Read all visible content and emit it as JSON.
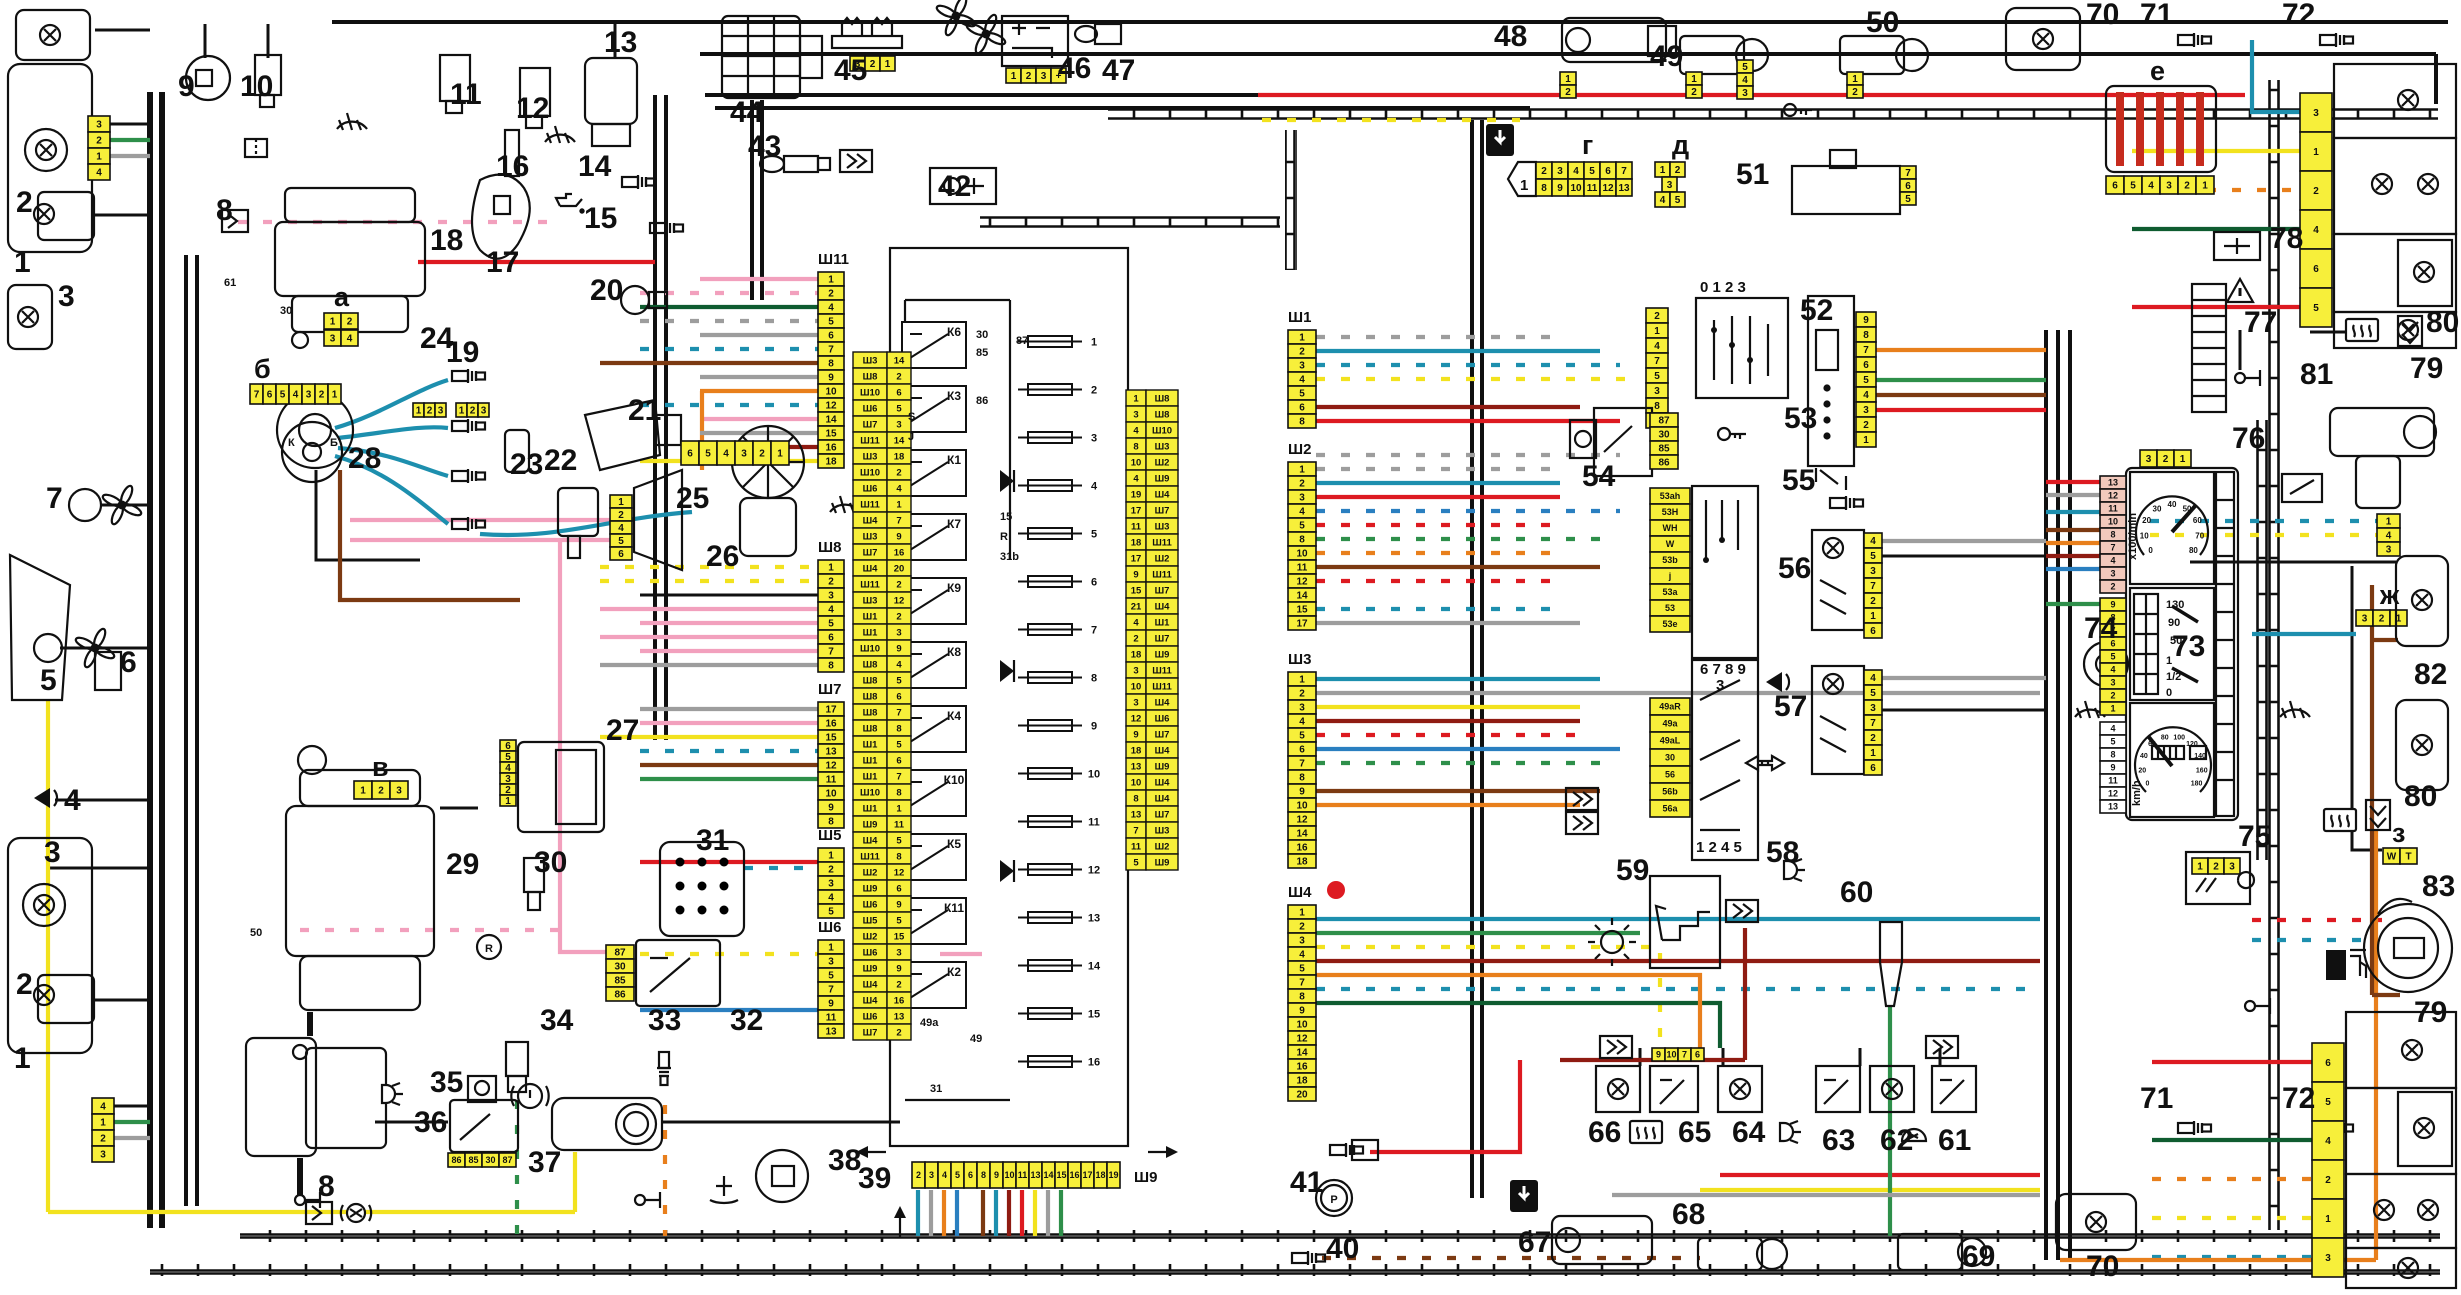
{
  "diagram": {
    "kind": "automotive wiring schematic",
    "note": "full-car electrical diagram with numbered components, connector blocks and central fuse-relay box",
    "bg": "#ffffff"
  },
  "palette": {
    "connector_yellow": "#f7ef3a",
    "block_blue": "#cfeff8",
    "glass_blue": "#bfe7f5",
    "lamp_orange": "#f08020",
    "lamp_red": "#e23b2e",
    "wire_red": "#dd1a21",
    "wire_pink": "#f2a0bd",
    "wire_teal": "#1d8fae",
    "wire_yellow": "#f2e21e",
    "wire_orange": "#e87f1c",
    "wire_green": "#2e8f4a",
    "wire_brown": "#7c3a12",
    "wire_gray": "#9d9d9d"
  },
  "labels": {
    "1": "1",
    "2": "2",
    "3": "3",
    "4": "4",
    "5": "5",
    "6": "6",
    "7": "7",
    "8": "8",
    "9": "9",
    "10": "10",
    "11": "11",
    "12": "12",
    "13": "13",
    "14": "14",
    "15": "15",
    "16": "16",
    "17": "17",
    "18": "18",
    "19": "19",
    "20": "20",
    "21": "21",
    "22": "22",
    "23": "23",
    "24": "24",
    "25": "25",
    "26": "26",
    "27": "27",
    "28": "28",
    "29": "29",
    "30": "30",
    "31": "31",
    "32": "32",
    "33": "33",
    "34": "34",
    "35": "35",
    "36": "36",
    "37": "37",
    "38": "38",
    "39": "39",
    "40": "40",
    "41": "41",
    "42": "42",
    "43": "43",
    "44": "44",
    "45": "45",
    "46": "46",
    "47": "47",
    "48": "48",
    "49": "49",
    "50": "50",
    "51": "51",
    "52": "52",
    "53": "53",
    "54": "54",
    "55": "55",
    "56": "56",
    "57": "57",
    "58": "58",
    "59": "59",
    "60": "60",
    "61": "61",
    "62": "62",
    "63": "63",
    "64": "64",
    "65": "65",
    "66": "66",
    "67": "67",
    "68": "68",
    "69": "69",
    "70": "70",
    "71": "71",
    "72": "72",
    "73": "73",
    "74": "74",
    "75": "75",
    "76": "76",
    "77": "77",
    "78": "78",
    "79": "79",
    "80": "80",
    "81": "81",
    "82": "82",
    "83": "83"
  },
  "letters": {
    "a": "а",
    "b": "б",
    "v": "в",
    "g": "г",
    "d": "д",
    "e": "е",
    "zh": "ж",
    "z": "з"
  },
  "wiremarks": {
    "m50": "50",
    "m61": "61",
    "m30": "30",
    "mK": "К",
    "mB": "Б",
    "mP": "P",
    "mR": "R"
  },
  "block": {
    "number": "39",
    "relays": [
      "К6",
      "К3",
      "К1",
      "К7",
      "К9",
      "К8",
      "К4",
      "К10",
      "К5",
      "К11",
      "К2"
    ],
    "fuses": [
      "1",
      "2",
      "3",
      "4",
      "5",
      "6",
      "7",
      "8",
      "9",
      "10",
      "11",
      "12",
      "13",
      "14",
      "15",
      "16"
    ],
    "marks": {
      "t30": "30",
      "t85": "85",
      "t86": "86",
      "t87": "87",
      "t15": "15",
      "t31": "31",
      "t31b": "31b",
      "tR": "R",
      "tJ": "J",
      "tS": "S",
      "t49a": "49a",
      "t49": "49"
    },
    "left_table": [
      [
        "Ш3",
        "14"
      ],
      [
        "Ш8",
        "2"
      ],
      [
        "Ш10",
        "6"
      ],
      [
        "Ш6",
        "5"
      ],
      [
        "Ш7",
        "3"
      ],
      [
        "Ш11",
        "14"
      ],
      [
        "Ш3",
        "18"
      ],
      [
        "Ш10",
        "2"
      ],
      [
        "Ш6",
        "4"
      ],
      [
        "Ш11",
        "1"
      ],
      [
        "Ш4",
        "7"
      ],
      [
        "Ш3",
        "9"
      ],
      [
        "Ш7",
        "16"
      ],
      [
        "Ш4",
        "20"
      ],
      [
        "Ш11",
        "2"
      ],
      [
        "Ш3",
        "12"
      ],
      [
        "Ш1",
        "2"
      ],
      [
        "Ш1",
        "3"
      ],
      [
        "Ш10",
        "9"
      ],
      [
        "Ш8",
        "4"
      ],
      [
        "Ш8",
        "5"
      ],
      [
        "Ш8",
        "6"
      ],
      [
        "Ш8",
        "7"
      ],
      [
        "Ш8",
        "8"
      ],
      [
        "Ш1",
        "5"
      ],
      [
        "Ш1",
        "6"
      ],
      [
        "Ш1",
        "7"
      ],
      [
        "Ш10",
        "8"
      ],
      [
        "Ш1",
        "1"
      ],
      [
        "Ш9",
        "11"
      ],
      [
        "Ш4",
        "5"
      ],
      [
        "Ш11",
        "8"
      ],
      [
        "Ш2",
        "12"
      ],
      [
        "Ш9",
        "6"
      ],
      [
        "Ш6",
        "9"
      ],
      [
        "Ш5",
        "5"
      ],
      [
        "Ш2",
        "15"
      ],
      [
        "Ш6",
        "3"
      ],
      [
        "Ш9",
        "9"
      ],
      [
        "Ш4",
        "2"
      ],
      [
        "Ш4",
        "16"
      ],
      [
        "Ш6",
        "13"
      ],
      [
        "Ш7",
        "2"
      ]
    ],
    "right_table": [
      [
        "1",
        "Ш8"
      ],
      [
        "3",
        "Ш8"
      ],
      [
        "4",
        "Ш10"
      ],
      [
        "8",
        "Ш3"
      ],
      [
        "10",
        "Ш2"
      ],
      [
        "4",
        "Ш9"
      ],
      [
        "19",
        "Ш4"
      ],
      [
        "17",
        "Ш7"
      ],
      [
        "11",
        "Ш3"
      ],
      [
        "18",
        "Ш11"
      ],
      [
        "17",
        "Ш2"
      ],
      [
        "9",
        "Ш11"
      ],
      [
        "15",
        "Ш7"
      ],
      [
        "21",
        "Ш4"
      ],
      [
        "4",
        "Ш1"
      ],
      [
        "2",
        "Ш7"
      ],
      [
        "18",
        "Ш9"
      ],
      [
        "3",
        "Ш11"
      ],
      [
        "10",
        "Ш11"
      ],
      [
        "3",
        "Ш4"
      ],
      [
        "12",
        "Ш6"
      ],
      [
        "9",
        "Ш7"
      ],
      [
        "18",
        "Ш4"
      ],
      [
        "13",
        "Ш9"
      ],
      [
        "10",
        "Ш4"
      ],
      [
        "8",
        "Ш4"
      ],
      [
        "13",
        "Ш7"
      ],
      [
        "7",
        "Ш3"
      ],
      [
        "11",
        "Ш2"
      ],
      [
        "5",
        "Ш9"
      ]
    ]
  },
  "conn": {
    "sh11": {
      "name": "Ш11",
      "pins": [
        "1",
        "2",
        "4",
        "5",
        "6",
        "7",
        "8",
        "9",
        "10",
        "12",
        "14",
        "15",
        "16",
        "18"
      ]
    },
    "sh8": {
      "name": "Ш8",
      "pins": [
        "1",
        "2",
        "3",
        "4",
        "5",
        "6",
        "7",
        "8"
      ]
    },
    "sh7": {
      "name": "Ш7",
      "pins": [
        "17",
        "16",
        "15",
        "13",
        "12",
        "11",
        "10",
        "9",
        "8"
      ]
    },
    "sh5": {
      "name": "Ш5",
      "pins": [
        "1",
        "2",
        "3",
        "4",
        "5"
      ]
    },
    "sh6": {
      "name": "Ш6",
      "pins": [
        "1",
        "3",
        "5",
        "7",
        "9",
        "11",
        "13"
      ]
    },
    "sh9": {
      "name": "Ш9",
      "pins": [
        "2",
        "3",
        "4",
        "5",
        "6",
        "8",
        "9",
        "10",
        "11",
        "13",
        "14",
        "15",
        "16",
        "17",
        "18",
        "19"
      ]
    },
    "sh1": {
      "name": "Ш1",
      "pins": [
        "1",
        "2",
        "3",
        "4",
        "5",
        "6",
        "8"
      ]
    },
    "sh2": {
      "name": "Ш2",
      "pins": [
        "1",
        "2",
        "3",
        "4",
        "5",
        "8",
        "10",
        "11",
        "12",
        "14",
        "15",
        "17"
      ]
    },
    "sh3": {
      "name": "Ш3",
      "pins": [
        "1",
        "2",
        "3",
        "4",
        "5",
        "6",
        "7",
        "8",
        "9",
        "10",
        "12",
        "14",
        "16",
        "18"
      ]
    },
    "sh4": {
      "name": "Ш4",
      "pins": [
        "1",
        "2",
        "3",
        "4",
        "5",
        "7",
        "8",
        "9",
        "10",
        "12",
        "14",
        "16",
        "18",
        "20"
      ]
    },
    "hl_top": [
      "3",
      "2",
      "1",
      "4"
    ],
    "hl_bot": [
      "4",
      "1",
      "2",
      "3"
    ],
    "a1": [
      "1",
      "2"
    ],
    "a2": [
      "3",
      "4"
    ],
    "b": [
      "7",
      "6",
      "5",
      "4",
      "3",
      "2",
      "1"
    ],
    "v": [
      "1",
      "2",
      "3"
    ],
    "g1": [
      "2",
      "3",
      "4",
      "5",
      "6",
      "7"
    ],
    "g2": [
      "8",
      "9",
      "10",
      "11",
      "12",
      "13"
    ],
    "g0": "1",
    "d1": [
      "1",
      "2"
    ],
    "d2": [
      "3"
    ],
    "d3": [
      "4",
      "5"
    ],
    "e": [
      "6",
      "5",
      "4",
      "3",
      "2",
      "1"
    ],
    "zh": [
      "3",
      "2",
      "1"
    ],
    "z": [
      "W",
      "T"
    ],
    "c45": [
      "3",
      "2",
      "1"
    ],
    "c46": [
      "1",
      "2",
      "3",
      "+"
    ],
    "c48": [
      "1",
      "2"
    ],
    "c49": [
      "1",
      "2"
    ],
    "c50": [
      "1",
      "2"
    ],
    "c50b": [
      "5",
      "4",
      "3"
    ],
    "c51": [
      "7",
      "6",
      "5"
    ],
    "c52": [
      "2",
      "1",
      "4",
      "7",
      "5",
      "3",
      "8",
      "6"
    ],
    "c52_header": "0 1 2 3",
    "c53": [
      "9",
      "8",
      "7",
      "6",
      "5",
      "4",
      "3",
      "2",
      "1"
    ],
    "c54": [
      "87",
      "30",
      "85",
      "86"
    ],
    "c56": [
      "4",
      "5",
      "3",
      "7",
      "2",
      "1",
      "6"
    ],
    "c57": [
      "4",
      "5",
      "3",
      "7",
      "2",
      "1",
      "6"
    ],
    "c58u": [
      "53ah",
      "53H",
      "WH",
      "W",
      "53b",
      "j",
      "53a",
      "53",
      "53e"
    ],
    "c58u_n1": "6 7 8 9",
    "c58u_n2": "3",
    "c58u_n3": "1 2 4 5",
    "c58l": [
      "49aR",
      "49a",
      "49aL",
      "30",
      "56",
      "56b",
      "56a"
    ],
    "c32": [
      "87",
      "30",
      "85",
      "86"
    ],
    "c36": [
      "86",
      "85",
      "30",
      "87"
    ],
    "c25": [
      "1",
      "2",
      "4",
      "5",
      "6"
    ],
    "c27": [
      "6",
      "5",
      "4",
      "3",
      "2",
      "1"
    ],
    "w26": [
      "6",
      "5",
      "4",
      "3",
      "2",
      "1"
    ],
    "sp1": [
      "1",
      "2",
      "3"
    ],
    "sp2": [
      "1",
      "2",
      "3"
    ],
    "c65": [
      "9",
      "10",
      "7",
      "6"
    ],
    "tail_top": [
      "3",
      "1",
      "2",
      "4",
      "6",
      "5"
    ],
    "tail_bot": [
      "6",
      "5",
      "4",
      "2",
      "1",
      "3"
    ],
    "w81": [
      "1",
      "4",
      "3"
    ],
    "p75": [
      "1",
      "2",
      "3"
    ],
    "cl_top": [
      "3",
      "2",
      "1"
    ],
    "cl_pink": [
      "13",
      "12",
      "11",
      "10",
      "8",
      "7",
      "4",
      "3",
      "2"
    ],
    "cl_yellow": [
      "9",
      "8",
      "7",
      "6",
      "5",
      "4",
      "3",
      "2",
      "1"
    ],
    "cl_white": [
      "4",
      "5",
      "8",
      "9",
      "11",
      "12",
      "13"
    ]
  },
  "cluster": {
    "number": "76",
    "tach_unit": "x100/min",
    "speed_unit": "km/h",
    "tach_ticks": [
      "0",
      "10",
      "20",
      "30",
      "40",
      "50",
      "60",
      "70",
      "80"
    ],
    "speed_ticks": [
      "0",
      "20",
      "40",
      "60",
      "80",
      "100",
      "120",
      "140",
      "160",
      "180"
    ],
    "temp": [
      "130",
      "90",
      "50"
    ],
    "fuel": [
      "1",
      "1/2",
      "0"
    ]
  }
}
